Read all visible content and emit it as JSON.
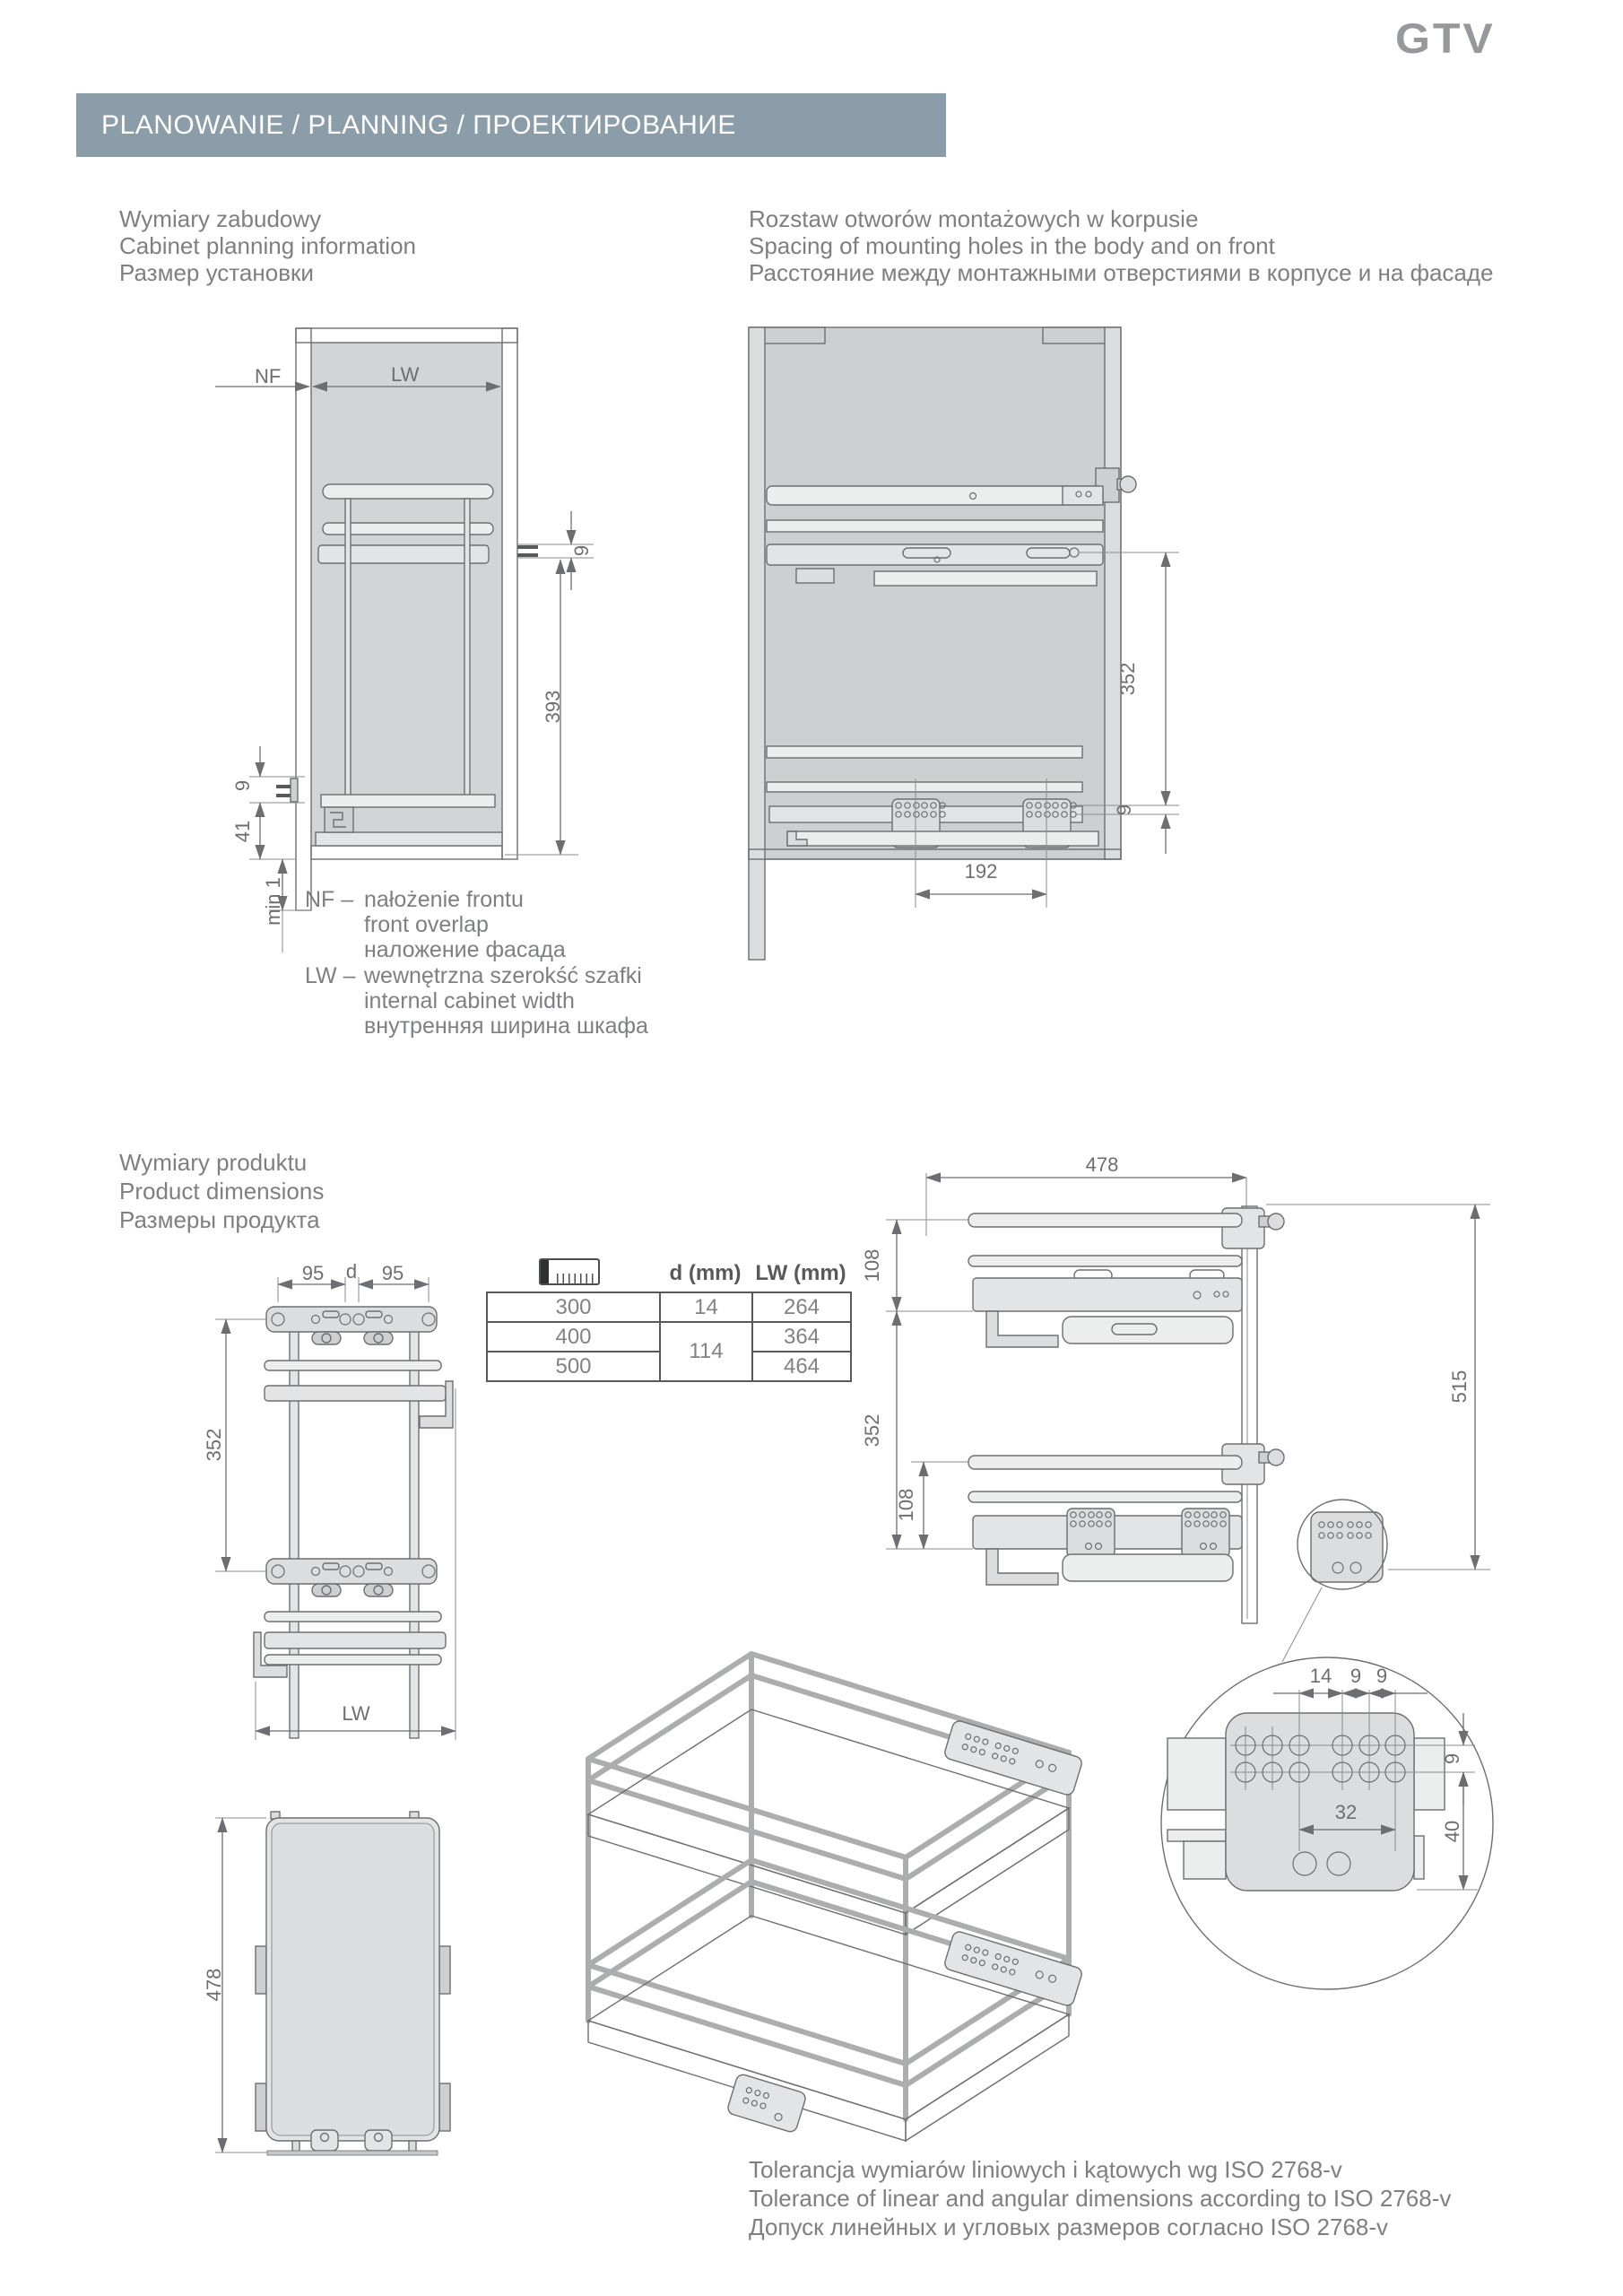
{
  "brand": {
    "logo": "GTV"
  },
  "header": {
    "title": "PLANOWANIE / PLANNING / ПРОЕКТИРОВАНИЕ"
  },
  "sections": {
    "cabinet": {
      "l1": "Wymiary zabudowy",
      "l2": "Cabinet planning information",
      "l3": "Размер установки"
    },
    "holes": {
      "l1": "Rozstaw otworów montażowych w korpusie",
      "l2": "Spacing of mounting holes in the body and on front",
      "l3": "Расстояние между монтажными отверстиями в корпусе и на фасаде"
    },
    "product": {
      "l1": "Wymiary produktu",
      "l2": "Product dimensions",
      "l3": "Размеры продукта"
    },
    "tolerance": {
      "l1": "Tolerancja wymiarów liniowych i kątowych wg ISO 2768-v",
      "l2": "Tolerance of linear and angular dimensions according to ISO 2768-v",
      "l3": "Допуск линейных и угловых размеров согласно ISO 2768-v"
    }
  },
  "legend": {
    "nf_term": "NF –",
    "nf1": "nałożenie frontu",
    "nf2": "front overlap",
    "nf3": "наложение фасада",
    "lw_term": "LW –",
    "lw1": "wewnętrzna szerokść szafki",
    "lw2": "internal cabinet width",
    "lw3": "внутренняя ширина шкафа"
  },
  "table": {
    "col_d": "d (mm)",
    "col_lw": "LW (mm)",
    "rows": [
      {
        "size": "300",
        "d": "14",
        "lw": "264"
      },
      {
        "size": "400",
        "d": "114",
        "lw": "364"
      },
      {
        "size": "500",
        "lw": "464"
      }
    ]
  },
  "dims": {
    "a_nf": "NF",
    "a_lw": "LW",
    "a_9r": "9",
    "a_393": "393",
    "a_9l": "9",
    "a_41": "41",
    "a_min1": "min 1",
    "b_352": "352",
    "b_9": "9",
    "b_192": "192",
    "c_95l": "95",
    "c_d": "d",
    "c_95r": "95",
    "c_352": "352",
    "c_lw": "LW",
    "d_478": "478",
    "d_108t": "108",
    "d_352": "352",
    "d_108b": "108",
    "d_515": "515",
    "det_14": "14",
    "det_9a": "9",
    "det_9b": "9",
    "det_9r": "9",
    "det_32": "32",
    "det_40": "40",
    "t_478": "478"
  },
  "colors": {
    "header_bar": "#8b9da8",
    "logo": "#96989b",
    "text": "#7d7f82",
    "line": "#6d6e71"
  }
}
